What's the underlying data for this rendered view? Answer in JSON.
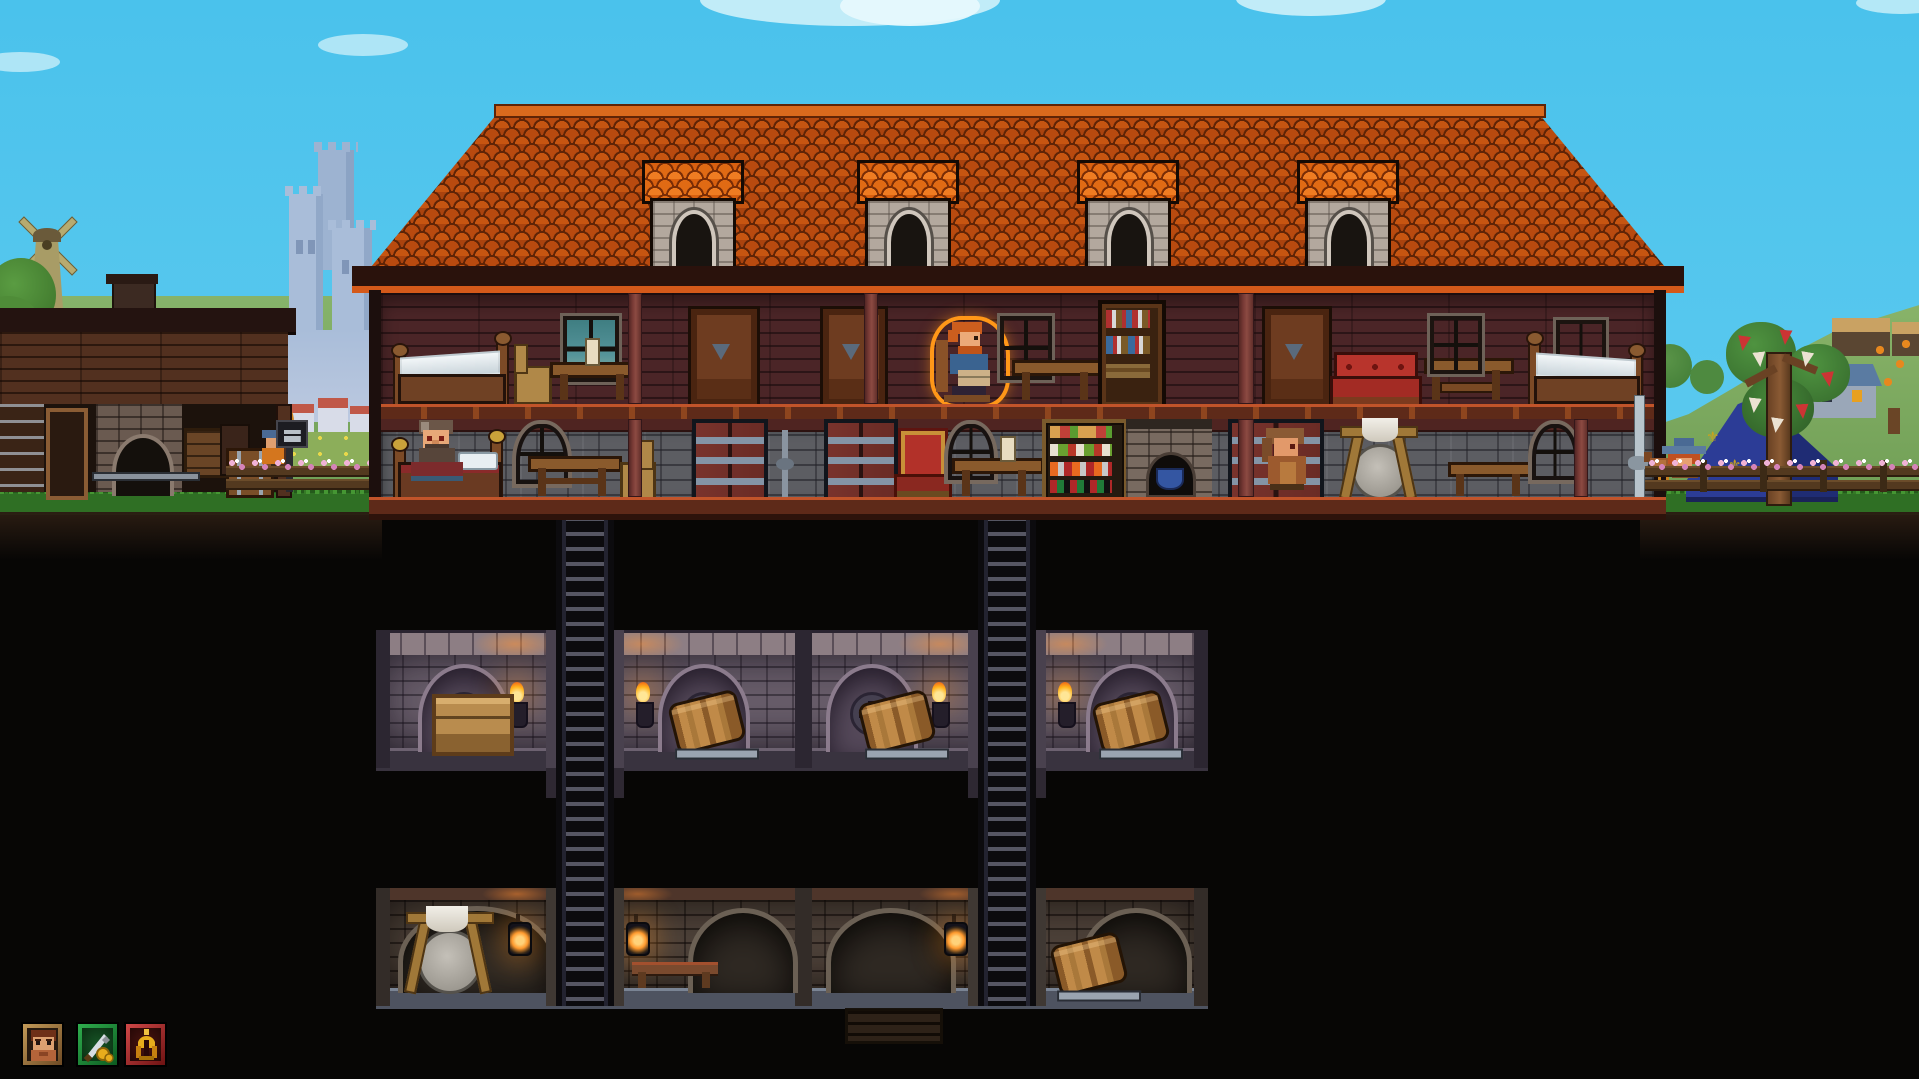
{
  "meta": {
    "type": "pixel-art settlement simulation game screenshot",
    "view": "2D side-on cutaway of a settlement: surface buildings above ground, excavated cellar levels below"
  },
  "palette": {
    "sky_top": "#4ac2ec",
    "sky_bottom": "#79d5f2",
    "cloud": "#c7eef9",
    "castle": "#a9bdd9",
    "hill_green": "#79a95e",
    "grass": "#2f6f24",
    "grass_tuft": "#459633",
    "earth_dark": "#070605",
    "roof_tile": "#aa430e",
    "roof_tile_light": "#d8600f",
    "roof_ridge": "#e07020",
    "wood_wall": "#4b2527",
    "wood_pillar": "#7a3b36",
    "stone_wall": "#5c5d62",
    "floor_band": "#5e2a19",
    "floor_edge": "#c1542a",
    "cellar_stone": "#695e6b",
    "cellar2_stone": "#55483f",
    "torch_flame": "#ffb41e",
    "lantern_glow": "#ff9a2e",
    "selection_outline": "#ff9718",
    "tent_blue": "#2c3c96",
    "tent_gold": "#c8a21e",
    "banner_red": "#cc3434",
    "banner_white": "#ece2d2",
    "ui_gold": "#e8ac1c",
    "ui_silver": "#d7dde3",
    "ui_green_frame": "#1f8a38",
    "ui_red_frame": "#b03030",
    "ui_brown_frame": "#8a6840"
  },
  "hud": {
    "buttons": [
      {
        "name": "portrait-button",
        "icon": "dwarf-portrait-icon",
        "frame": "#8a6840"
      },
      {
        "name": "sword-coins-button",
        "icon": "sword-coins-icon",
        "frame": "#1f8a38"
      },
      {
        "name": "gold-helmet-button",
        "icon": "gold-helmet-icon",
        "frame": "#b03030"
      }
    ]
  },
  "scene": {
    "background": [
      "clouds",
      "castle-silhouette",
      "windmill",
      "rolling-hills",
      "village-houses",
      "blue-roof-house",
      "orchard-tree",
      "winding-path"
    ],
    "surface": {
      "forge_hut": [
        "chimney",
        "stone-furnace",
        "tool-rack",
        "door-frame",
        "crates",
        "storage-chest",
        "anvil-signpost",
        "villager",
        "flower-fence"
      ],
      "main_house": {
        "dormers": 4,
        "upper_floor": [
          "bed",
          "chair",
          "candle-table",
          "teal-window",
          "wardrobe",
          "wardrobe",
          "selected-reading-villager",
          "window",
          "table",
          "bookshelf",
          "wardrobe",
          "red-sofa",
          "bench-table",
          "window",
          "bed"
        ],
        "ground_floor": [
          "bed-with-dwarf",
          "stained-glass-window",
          "table",
          "chair",
          "steel-door",
          "steel-door",
          "red-throne",
          "round-green-window",
          "candle-table",
          "pantry-shelf",
          "stone-furnace",
          "steel-door",
          "hooded-villager",
          "grindstone",
          "bench",
          "blue-stained-window",
          "drain-pipe"
        ]
      },
      "camp": {
        "tent_symbol": "⚜",
        "elements": [
          "blue-royal-tent",
          "banner-tree",
          "flower-fence",
          "chicken",
          "farmer-with-hat"
        ]
      }
    },
    "underground": {
      "ladder_shafts": 2,
      "basement_1": [
        "vaulted-cellar-rooms",
        "cross-plaques",
        "wall-torches",
        "storage-crate",
        "kegs"
      ],
      "basement_2": [
        "stone-rooms",
        "hanging-lanterns",
        "grindstone",
        "bench",
        "keg",
        "buried-crate"
      ]
    },
    "characters": [
      {
        "name": "dwarf-in-bed",
        "location": "ground-floor-left",
        "selected": false
      },
      {
        "name": "reading-villager",
        "location": "upper-floor-center",
        "selected": true
      },
      {
        "name": "hooded-villager",
        "location": "ground-floor-right",
        "selected": false
      },
      {
        "name": "farmer",
        "location": "outside-right",
        "selected": false
      },
      {
        "name": "chicken",
        "location": "outside-right",
        "selected": false
      }
    ]
  }
}
